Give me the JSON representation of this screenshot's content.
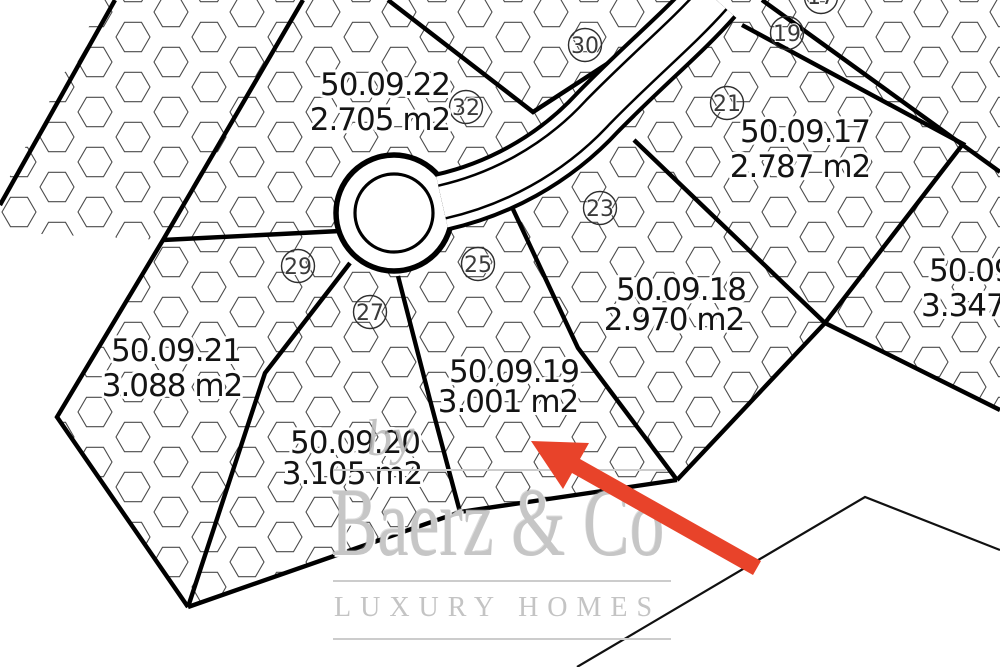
{
  "map_title": "cadastral site plan",
  "plots": [
    {
      "number": "50.09.22",
      "area": "2.705 m2"
    },
    {
      "number": "50.09.17",
      "area": "2.787 m2"
    },
    {
      "number": "50.09.18",
      "area": "2.970 m2"
    },
    {
      "number": "50.09.19",
      "area": "3.001 m2"
    },
    {
      "number": "50.09.20",
      "area": "3.105 m2"
    },
    {
      "number": "50.09.21",
      "area": "3.088 m2"
    },
    {
      "number": "50.09",
      "area": "3.347"
    }
  ],
  "markers": [
    {
      "label": "17"
    },
    {
      "label": "19"
    },
    {
      "label": "21"
    },
    {
      "label": "23"
    },
    {
      "label": "25"
    },
    {
      "label": "27"
    },
    {
      "label": "29"
    },
    {
      "label": "30"
    },
    {
      "label": "32"
    }
  ],
  "watermark": {
    "prefix": "by",
    "brand": "Baerz & Co",
    "tagline": "LUXURY HOMES"
  },
  "colors": {
    "arrow": "#e8432a",
    "boundary": "#000000",
    "hex_outline": "#4b4b4b",
    "watermark_gray": "#c6c6c6"
  }
}
